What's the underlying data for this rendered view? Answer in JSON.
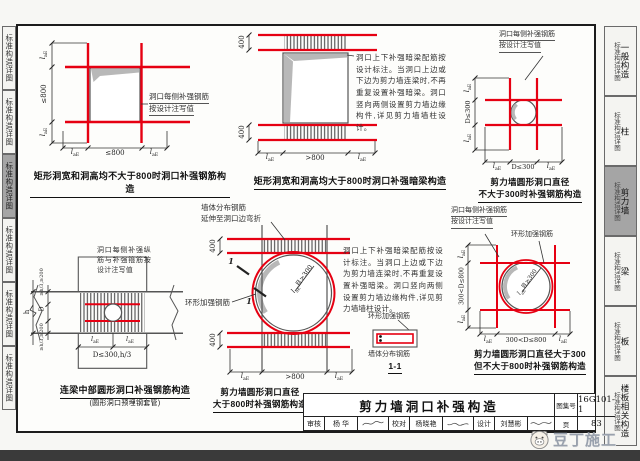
{
  "colors": {
    "red": "#e60012",
    "tab_active": "#a5a5a5",
    "bottom_bar": "#3a3a3a"
  },
  "sym": {
    "l": "l",
    "aE": "aE"
  },
  "tabs": {
    "side_label": "标准构造详图",
    "right": [
      {
        "category": "一般构造"
      },
      {
        "category": "柱"
      },
      {
        "category": "剪力墙"
      },
      {
        "category": "梁"
      },
      {
        "category": "板"
      },
      {
        "category": "楼板相关构造"
      }
    ]
  },
  "d1": {
    "caption": "矩形洞宽和洞高均不大于800时洞口补强钢筋构造",
    "leader1": "洞口每侧补强钢筋",
    "leader2": "按设计注写值",
    "dim_mid": "≤800"
  },
  "d2": {
    "caption": "矩形洞宽和洞高均大于800时洞口补强暗梁构造",
    "note": "洞口上下补强暗梁配筋按设计标注。当洞口上边或下边为剪力墙连梁时,不再重复设置补强暗梁。洞口竖向两侧设置剪力墙边缘构件,详见剪力墙墙柱设计。",
    "dim_band": "400",
    "dim_mid": ">800"
  },
  "d3": {
    "caption1": "剪力墙圆形洞口直径",
    "caption2": "不大于300时补强钢筋构造",
    "leader1": "洞口每侧补强钢筋",
    "leader2": "按设计注写值",
    "dim_mid": "D≤300"
  },
  "d4": {
    "caption": "连梁中部圆形洞口补强钢筋构造",
    "subcaption": "(圆形洞口预埋钢套管)",
    "note": "洞口每侧补强纵筋与补强箍筋按设计注写值",
    "dim_side_top": "≥h/3,≥200",
    "dim_side_bot": "≥h/3,≥200",
    "dim_d": "D",
    "dim_h": "h",
    "dim_bottom": "D≤300,h/3"
  },
  "d5": {
    "caption1": "剪力墙圆形洞口直径",
    "caption2": "大于800时补强钢筋构造",
    "label_dist1": "墙体分布钢筋",
    "label_dist2": "延伸至洞口边弯折",
    "label_ring": "环形加强钢筋",
    "dim_ring": "且≥300",
    "dim_band": "400",
    "dim_mid": ">800",
    "mark": "1",
    "section": {
      "title": "1-1",
      "label_ring": "环形加强钢筋",
      "label_dist": "墙体分布钢筋"
    }
  },
  "d6": {
    "caption1": "剪力墙圆形洞口直径大于300",
    "caption2": "但不大于800时补强钢筋构造",
    "leader1": "洞口每侧补强钢筋",
    "leader2": "按设计注写值",
    "label_ring": "环形加强钢筋",
    "dim_mid": "300<D≤800",
    "dim_ring": "且≥300"
  },
  "title_block": {
    "title": "剪力墙洞口补强构造",
    "atlas_label": "图集号",
    "atlas_no": "16G101-1",
    "page_label": "页",
    "page_no": "83",
    "reviewer_label": "审核",
    "reviewer_name": "杨 华",
    "proof_label": "校对",
    "proof_name": "杨晓艳",
    "design_label": "设计",
    "design_name": "刘慧彬"
  },
  "watermark": {
    "text": "豆丁施工"
  }
}
